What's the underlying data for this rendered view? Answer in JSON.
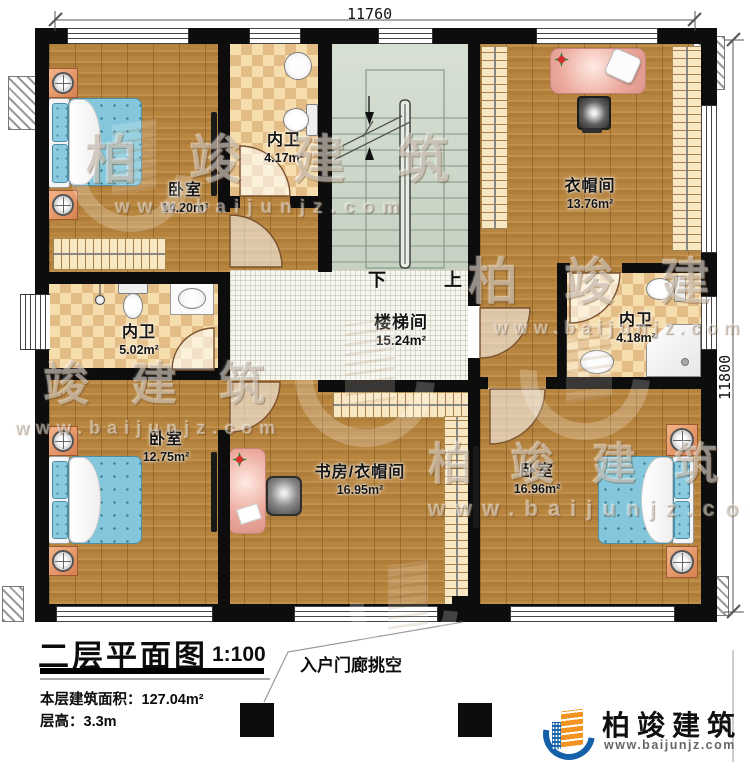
{
  "dimensions": {
    "top": "11760",
    "right": "11800"
  },
  "rooms": {
    "bedroom_tl": {
      "name": "卧室",
      "area": "14.20m²"
    },
    "bath_tl": {
      "name": "内卫",
      "area": "4.17m²"
    },
    "wic": {
      "name": "衣帽间",
      "area": "13.76m²"
    },
    "bath_left": {
      "name": "内卫",
      "area": "5.02m²"
    },
    "stairwell": {
      "name": "楼梯间",
      "area": "15.24m²"
    },
    "bath_right": {
      "name": "内卫",
      "area": "4.18m²"
    },
    "bedroom_bl": {
      "name": "卧室",
      "area": "12.75m²"
    },
    "study": {
      "name": "书房/衣帽间",
      "area": "16.95m²"
    },
    "bedroom_br": {
      "name": "卧室",
      "area": "16.96m²"
    }
  },
  "stairs": {
    "down_label": "下",
    "up_label": "上"
  },
  "titleblock": {
    "title": "二层平面图",
    "scale": "1:100",
    "area_label": "本层建筑面积：",
    "area_value": "127.04m²",
    "floor_height_label": "层高：",
    "floor_height_value": "3.3m"
  },
  "annotations": {
    "porch": "入户门廊挑空"
  },
  "watermark": {
    "brand": "柏竣建筑",
    "url": "www.baijunjz.com"
  },
  "logo": {
    "brand": "柏竣建筑",
    "url": "www.baijunjz.com"
  },
  "colors": {
    "wall": "#0d0d0d",
    "wood": "#b8853f",
    "checker_dark": "#e3bc86",
    "stair_floor": "#cfd9cb",
    "bed_blue": "#84c7dc",
    "nightstand_orange": "#e2956a",
    "logo_blue": "#1461a9",
    "logo_orange": "#f39422"
  }
}
